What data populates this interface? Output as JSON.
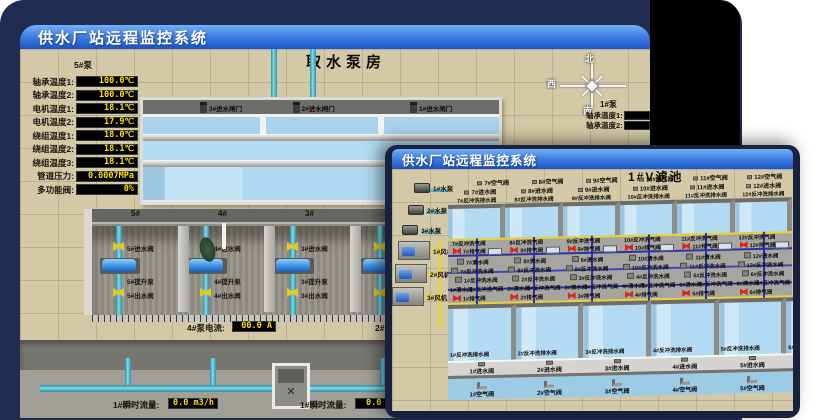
{
  "colors": {
    "backdrop": "#212c52",
    "titlebar_top": "#73b0f4",
    "titlebar_bottom": "#1c55c4",
    "value_text": "#ffdf00",
    "value_bg": "#000000",
    "floor_beige": "#d3c9a7",
    "water_blue": "#b2daf2",
    "pipe_cyan": "#7fdce8",
    "valve_yellow": "#e9c71b",
    "valve_red": "#d92817"
  },
  "back_window": {
    "title": "供水厂站远程监控系统",
    "room_title": "取水泵房",
    "pump_panel": {
      "header": "5#泵",
      "rows": [
        {
          "label": "轴承温度1:",
          "value": "100.0℃"
        },
        {
          "label": "轴承温度2:",
          "value": "100.0℃"
        },
        {
          "label": "电机温度1:",
          "value": "18.1℃"
        },
        {
          "label": "电机温度2:",
          "value": "17.9℃"
        },
        {
          "label": "绕组温度1:",
          "value": "18.0℃"
        },
        {
          "label": "绕组温度2:",
          "value": "18.1℃"
        },
        {
          "label": "绕组温度3:",
          "value": "18.1℃"
        },
        {
          "label": "管道压力:",
          "value": "0.0007MPa"
        },
        {
          "label": "多功能阀:",
          "value": "0%"
        }
      ]
    },
    "gates": [
      "3#进水闸门",
      "2#进水闸门",
      "1#进水闸门"
    ],
    "bays": [
      {
        "num": "5#",
        "inlet": "5#进水阀",
        "pump": "5#提升泵",
        "outlet": "5#出水阀"
      },
      {
        "num": "4#",
        "inlet": "4#进水阀",
        "pump": "4#提升泵",
        "outlet": "4#出水阀"
      },
      {
        "num": "3#",
        "inlet": "3#进水阀",
        "pump": "3#提升泵",
        "outlet": "3#出水阀"
      },
      {
        "num": "2#",
        "inlet": "",
        "pump": "",
        "outlet": ""
      }
    ],
    "current_left": {
      "label": "4#泵电流:",
      "value": "00.0 A"
    },
    "current_right_label": "2#泵电流:",
    "flow_left": {
      "label": "1#瞬时流量:",
      "value": "0.0 m3/h"
    },
    "flow_right": {
      "label": "1#瞬时流量:",
      "value": "0.0 m3/h"
    },
    "compass": {
      "north": "北",
      "west": "西",
      "south": "南"
    },
    "right_panel": {
      "header": "1#泵",
      "rows": [
        "轴承温度1:",
        "轴承温度2:"
      ]
    }
  },
  "front_window": {
    "title": "供水厂站远程监控系统",
    "pool_title": "1#V滤池",
    "pumps": [
      "1#水泵",
      "2#水泵",
      "3#水泵"
    ],
    "blowers": [
      "1#风机",
      "2#风机",
      "3#风机"
    ],
    "top_air": [
      "7#空气阀",
      "8#空气阀",
      "9#空气阀",
      "10#空气阀",
      "11#空气阀",
      "12#空气阀"
    ],
    "top_inlet": [
      "7#进水阀",
      "8#进水阀",
      "9#进水阀",
      "10#进水阀",
      "11#进水阀",
      "12#进水阀"
    ],
    "top_drain": [
      "7#反冲洗排水阀",
      "8#反冲洗排水阀",
      "9#反冲洗排水阀",
      "10#反冲洗排水阀",
      "11#反冲洗排水阀",
      "12#反冲洗排水阀"
    ],
    "gallery": [
      {
        "u_air": "7#反冲洗气阀",
        "u_vent": "7#排气阀",
        "u_clean": "7#清水阀",
        "u_wash": "7#反冲洗水阀",
        "l_wash": "1#反冲洗水阀",
        "l_clean": "1#清水阀",
        "l_air": "1#反冲洗气阀",
        "l_vent": "1#排气阀"
      },
      {
        "u_air": "8#反冲洗气阀",
        "u_vent": "8#排气阀",
        "u_clean": "8#清水阀",
        "u_wash": "8#反冲洗水阀",
        "l_wash": "2#反冲洗水阀",
        "l_clean": "2#清水阀",
        "l_air": "2#反冲洗气阀",
        "l_vent": "2#排气阀"
      },
      {
        "u_air": "9#反冲洗气阀",
        "u_vent": "9#排气阀",
        "u_clean": "9#清水阀",
        "u_wash": "9#反冲洗水阀",
        "l_wash": "3#反冲洗水阀",
        "l_clean": "3#清水阀",
        "l_air": "3#反冲洗气阀",
        "l_vent": "3#排气阀"
      },
      {
        "u_air": "10#反冲洗气阀",
        "u_vent": "10#排气阀",
        "u_clean": "10#清水阀",
        "u_wash": "10#反冲洗水阀",
        "l_wash": "4#反冲洗水阀",
        "l_clean": "4#清水阀",
        "l_air": "4#反冲洗气阀",
        "l_vent": "4#排气阀"
      },
      {
        "u_air": "11#反冲洗气阀",
        "u_vent": "11#排气阀",
        "u_clean": "11#清水阀",
        "u_wash": "11#反冲洗水阀",
        "l_wash": "5#反冲洗水阀",
        "l_clean": "5#清水阀",
        "l_air": "5#反冲洗气阀",
        "l_vent": "5#排气阀"
      },
      {
        "u_air": "12#反冲洗气阀",
        "u_vent": "12#排气阀",
        "u_clean": "12#清水阀",
        "u_wash": "12#反冲洗水阀",
        "l_wash": "6#反冲洗水阀",
        "l_clean": "6#清水阀",
        "l_air": "6#反冲洗气阀",
        "l_vent": "6#排气阀"
      }
    ],
    "lower_drain": [
      "1#反冲洗排水阀",
      "2#反冲洗排水阀",
      "3#反冲洗排水阀",
      "4#反冲洗排水阀",
      "5#反冲洗排水阀",
      "6#反冲洗排水阀"
    ],
    "bottom_inlet": [
      "1#进水阀",
      "2#进水阀",
      "3#进水阀",
      "4#进水阀",
      "5#进水阀",
      "6#进水阀"
    ],
    "bottom_air": [
      "1#空气阀",
      "2#空气阀",
      "3#空气阀",
      "4#空气阀",
      "5#空气阀",
      "6#空气阀"
    ]
  }
}
